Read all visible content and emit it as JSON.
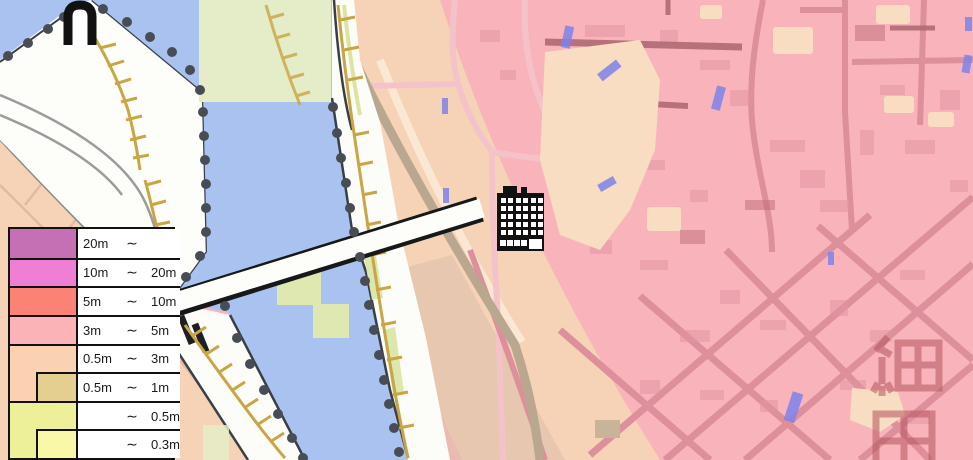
{
  "map": {
    "kind": "flood-hazard-map",
    "place_label": "細田",
    "markers": {
      "building_marker_icon": "apartment-building-icon",
      "monument_marker_icon": "monument-icon"
    },
    "legend": {
      "rows": [
        {
          "min": "20m",
          "tilde": "∼",
          "max": "",
          "color": "#c56fb5"
        },
        {
          "min": "10m",
          "tilde": "∼",
          "max": "20m",
          "color": "#ef7fd5"
        },
        {
          "min": "5m",
          "tilde": "∼",
          "max": "10m",
          "color": "#fb8375"
        },
        {
          "min": "3m",
          "tilde": "∼",
          "max": "5m",
          "color": "#fcb3b8"
        },
        {
          "min": "0.5m",
          "tilde": "∼",
          "max": "3m",
          "color": "#fad2b2"
        },
        {
          "min": "0.5m",
          "tilde": "∼",
          "max": "1m",
          "color": "#e5cf90"
        },
        {
          "min": "",
          "tilde": "∼",
          "max": "0.5m",
          "color": "#eef099"
        },
        {
          "min": "",
          "tilde": "∼",
          "max": "0.3m",
          "color": "#f8f8a6"
        }
      ]
    },
    "colors": {
      "flood_3m_5m_fill": "#f8b4ba",
      "flood_0_5m_3m_fill": "#f6d3b6",
      "flood_under_0_5m_fill": "#e5ecc8",
      "river_fill": "#a9c2ef",
      "levee_hatch": "#c9a544",
      "shoreline_dot": "#474c55",
      "marker_color": "#111111"
    }
  }
}
